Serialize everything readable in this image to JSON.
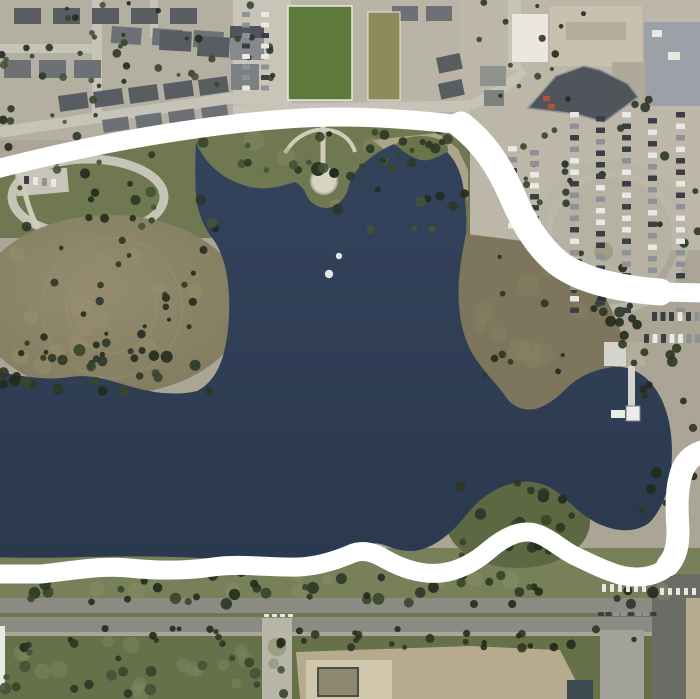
{
  "map": {
    "description_label": "satellite-aerial-view-lake-with-drawn-route",
    "width": 700,
    "height": 699
  },
  "colors": {
    "landBase": "#aaa595",
    "baseTL": "#b3afa1",
    "baseMid": "#b8b4a6",
    "baseTR": "#bcb7a9",
    "parkGreen": "#6f7850",
    "grassBand": "#78805a",
    "scrub": "#667049",
    "water1": "#33435c",
    "water2": "#2b394e",
    "peninsula1": "#958c6f",
    "peninsula2": "#7e7a5e",
    "fieldEast": "#7d765c",
    "fieldGreen": "#5d7a3b",
    "fieldOlive": "#8c8a5a",
    "plaza": "#c8c5b8",
    "streetLight": "#c6c3b7",
    "roadGray": "#8b8b83",
    "roadVert": "#a2a29a",
    "branchRoad": "#b8b5a9",
    "pavementDark": "#6c6c67",
    "median": "#6e7852",
    "dirt": "#b6ab8f",
    "pad": "#cfc6ac",
    "pitDark": "#8e8872",
    "roofDark": "#595d62",
    "roofMid": "#6d7176",
    "buildingWhite": "#e9e7e0",
    "buildingTan": "#c8c1af",
    "buildingTanDark": "#b4ad9a",
    "buildingGray": "#9ba1a6",
    "buildingWing": "#b0a999",
    "stripMall": "#4f555a",
    "midBldgA": "#87898d",
    "midBldgB": "#7d8084",
    "smallBlockA": "#8f938f",
    "smallBlockB": "#7e827e",
    "redAwning": "#b0503a",
    "beach": "#b3aa90",
    "knobGreen": "#6b7348",
    "sePenGreen": "#5c6842",
    "monumentPath": "#cfccba",
    "plazaCircle": "#d7d3c3",
    "ringRoad": "#b8b4a8",
    "loopFill": "#b5b1a3",
    "pierDeck": "#d5d5cd",
    "pierHead": "#eceeea",
    "fountainWhite": "#f2f5f4",
    "dashWhite": "#e9e9e4",
    "treeA": "#2c3626",
    "treeB": "#38452c",
    "treeC": "#222b1c",
    "treeD": "#45523a",
    "mottleLight": "#7d8760",
    "mottleTan": "#9a906f",
    "mottleField": "#8b8266",
    "mottleGrass": "#8a9168",
    "carDark": "#3a3f46",
    "carLight": "#e8e8e4",
    "carGray": "#8e9297",
    "carRed": "#a34a36",
    "annotation": "#ffffff"
  },
  "annotation": {
    "stroke_width": 19,
    "segments": [
      "M -8 170 C 40 158 90 146 150 136 C 210 126 280 117 340 117 C 380 117 430 121 461 125 C 484 143 499 166 511 193 C 523 221 536 245 558 263 C 582 281 620 289 660 292 L 708 293",
      "M 708 449 C 694 452 684 461 680 477 C 675 494 676 514 677 531 C 678 548 675 560 663 570 C 649 579 629 579 611 572 C 597 567 586 561 575 556 C 561 549 549 537 535 533 C 519 529 503 538 489 550 C 475 562 459 571 441 573 C 421 575 401 568 385 559 C 373 552 363 549 351 554 C 337 560 319 566 299 567 C 271 568 241 563 213 567 C 185 571 157 571 129 568 C 101 565 71 571 41 574 L -8 574"
    ],
    "overlay_ne": "M 461 125 C 484 143 499 166 511 193 C 523 221 536 245 558 263 C 582 281 620 289 660 292",
    "overlay_ne_width": 27,
    "overlay_right": "M 702 452 C 690 456 683 464 680 478 C 676 494 677 514 678 530 C 678 545 676 556 668 565",
    "overlay_right_width": 23
  },
  "water_features": {
    "lake_path": "M196 142 C205 165 225 181 250 187 C270 191 284 185 295 182 C302 186 305 191 307 196 C310 203 318 208 327 208 C337 207 345 199 348 189 C350 179 355 171 363 164 C372 156 382 149 394 144 C402 150 411 158 421 160 C431 162 440 155 447 152 C456 161 462 174 464 192 C466 207 467 220 466 233 C462 255 457 278 459 305 C461 330 467 347 478 362 C489 377 499 387 506 397 C513 407 523 411 535 409 C548 406 559 396 570 385 C582 375 596 369 613 367 C623 366 633 369 642 375 C653 383 662 396 667 414 C672 431 673 451 671 470 C669 490 662 510 649 523 C635 533 617 532 599 524 C583 517 571 503 557 492 C544 482 528 479 510 484 C493 489 478 500 467 514 C456 528 443 541 426 548 C411 554 397 550 384 545 C372 541 363 545 353 552 C341 559 325 563 306 563 C271 563 236 560 201 558 C161 556 121 556 81 557 C51 558 21 558 -6 557 L-6 371 C20 376 45 381 70 377 C95 373 115 383 140 389 C160 394 181 395 197 391 C209 385 218 373 223 356 C228 338 230 317 229 296 C228 273 223 253 213 239 C204 228 198 213 196 197 C195 179 195 159 196 142 Z",
    "fountain_dots": [
      {
        "x": 339,
        "y": 256,
        "r": 3.2
      },
      {
        "x": 329,
        "y": 274,
        "r": 4.2
      }
    ],
    "pier": {
      "deck": {
        "x": 628,
        "y": 366,
        "w": 7,
        "h": 47
      },
      "platform": {
        "x": 611,
        "y": 410,
        "w": 14,
        "h": 8
      },
      "head": {
        "x": 626,
        "y": 406,
        "w": 14,
        "h": 15
      }
    }
  },
  "land_features": {
    "east_field_path": "M450 232 L540 243 C563 251 580 263 594 281 C607 297 616 317 623 339 C628 355 624 363 611 368 C597 373 582 379 571 387 C560 396 548 410 534 412 C520 414 505 410 495 398 C482 383 470 365 463 345 C455 322 452 298 453 274 C454 256 449 240 450 232 Z",
    "park_band_points": "0,178 100,152 200,133 300,125 400,124 470,129 470,238 0,238",
    "beach_points": "372,140 438,133 458,149 468,170 468,200 452,168 418,160 386,151",
    "monument_arc": "M285 153 C295 136 312 128 327 130 C342 131 352 141 355 152",
    "monument_walk": "M323 126 L323 170",
    "diag_street": "M0 132 L233 98",
    "mid_road": "M233 110 L470 106",
    "tr_road": "M470 106 C500 92 515 80 524 70",
    "strip_mall_path": "M528 108 L556 76 L584 66 L600 70 L628 84 L638 97 L604 122 L576 114 Z"
  },
  "seed": 20240613,
  "decorations": {
    "blob_regions": [
      {
        "layer": "blobs-layer",
        "name": "ground-mottle",
        "x": 0,
        "y": 640,
        "w": 300,
        "h": 55,
        "n": 18,
        "rmin": 5,
        "rmax": 10,
        "op": 0.5,
        "colors": [
          "mottleLight"
        ]
      },
      {
        "layer": "blobs-layer",
        "name": "ground-mottle",
        "x": 15,
        "y": 250,
        "w": 200,
        "h": 118,
        "n": 14,
        "rmin": 6,
        "rmax": 12,
        "op": 0.45,
        "colors": [
          "mottleTan"
        ]
      },
      {
        "layer": "blobs-layer",
        "name": "ground-mottle",
        "x": 465,
        "y": 250,
        "w": 140,
        "h": 118,
        "n": 12,
        "rmin": 6,
        "rmax": 12,
        "op": 0.45,
        "colors": [
          "mottleField"
        ]
      },
      {
        "layer": "blobs-layer",
        "name": "ground-mottle",
        "x": 0,
        "y": 575,
        "w": 700,
        "h": 24,
        "n": 16,
        "rmin": 5,
        "rmax": 9,
        "op": 0.4,
        "colors": [
          "mottleGrass"
        ]
      },
      {
        "layer": "blobs-layer",
        "name": "ground-mottle",
        "x": 235,
        "y": 130,
        "w": 230,
        "h": 90,
        "n": 10,
        "rmin": 6,
        "rmax": 11,
        "op": 0.35,
        "colors": [
          "mottleGrass"
        ]
      }
    ],
    "tree_regions": [
      {
        "x": 0,
        "y": 0,
        "w": 230,
        "h": 126,
        "n": 40,
        "rmin": 2,
        "rmax": 4.5,
        "colors": [
          "treeA",
          "treeB",
          "treeC",
          "treeD"
        ]
      },
      {
        "x": 233,
        "y": 0,
        "w": 58,
        "h": 100,
        "n": 8,
        "rmin": 2,
        "rmax": 4,
        "colors": [
          "treeA",
          "treeB"
        ]
      },
      {
        "x": 470,
        "y": 0,
        "w": 120,
        "h": 108,
        "n": 14,
        "rmin": 2,
        "rmax": 4,
        "colors": [
          "treeA",
          "treeC",
          "treeB"
        ]
      },
      {
        "x": 560,
        "y": 95,
        "w": 138,
        "h": 235,
        "n": 16,
        "rmin": 2.5,
        "rmax": 5,
        "colors": [
          "treeA",
          "treeC"
        ]
      },
      {
        "x": 0,
        "y": 130,
        "w": 468,
        "h": 100,
        "n": 52,
        "rmin": 2.5,
        "rmax": 5.5,
        "colors": [
          "treeA",
          "treeB",
          "treeC",
          "treeD"
        ]
      },
      {
        "x": 10,
        "y": 240,
        "w": 208,
        "h": 128,
        "n": 30,
        "rmin": 2,
        "rmax": 4.5,
        "colors": [
          "treeA",
          "treeC"
        ]
      },
      {
        "x": 0,
        "y": 350,
        "w": 212,
        "h": 44,
        "n": 26,
        "rmin": 3,
        "rmax": 6,
        "colors": [
          "treeA",
          "treeC",
          "treeB"
        ]
      },
      {
        "x": 360,
        "y": 125,
        "w": 108,
        "h": 44,
        "n": 14,
        "rmin": 2.5,
        "rmax": 5,
        "colors": [
          "treeA",
          "treeB"
        ]
      },
      {
        "x": 470,
        "y": 250,
        "w": 138,
        "h": 128,
        "n": 10,
        "rmin": 2,
        "rmax": 4,
        "colors": [
          "treeA",
          "treeC"
        ]
      },
      {
        "x": 460,
        "y": 482,
        "w": 118,
        "h": 78,
        "n": 20,
        "rmin": 3,
        "rmax": 6,
        "colors": [
          "treeA",
          "treeC",
          "treeB"
        ]
      },
      {
        "x": 0,
        "y": 570,
        "w": 655,
        "h": 34,
        "n": 46,
        "rmin": 3,
        "rmax": 6,
        "colors": [
          "treeA",
          "treeC",
          "treeB"
        ]
      },
      {
        "x": 0,
        "y": 628,
        "w": 700,
        "h": 20,
        "n": 40,
        "rmin": 2.5,
        "rmax": 5,
        "colors": [
          "treeA",
          "treeC"
        ]
      },
      {
        "x": 0,
        "y": 645,
        "w": 285,
        "h": 50,
        "n": 22,
        "rmin": 3,
        "rmax": 6,
        "colors": [
          "treeB",
          "treeA",
          "treeD"
        ]
      },
      {
        "x": 630,
        "y": 330,
        "w": 68,
        "h": 188,
        "n": 18,
        "rmin": 3,
        "rmax": 5.5,
        "colors": [
          "treeA",
          "treeC"
        ]
      },
      {
        "x": 580,
        "y": 295,
        "w": 68,
        "h": 50,
        "n": 12,
        "rmin": 3,
        "rmax": 5.5,
        "colors": [
          "treeA",
          "treeC"
        ]
      },
      {
        "x": 520,
        "y": 130,
        "w": 58,
        "h": 78,
        "n": 10,
        "rmin": 2,
        "rmax": 4,
        "colors": [
          "treeA",
          "treeB"
        ]
      }
    ],
    "house_rows": [
      {
        "x": 14,
        "y": 8,
        "n": 5,
        "dx": 39,
        "dy": 0,
        "w": 27,
        "h": 16,
        "rot": 0,
        "color": "roofDark"
      },
      {
        "x": 112,
        "y": 26,
        "n": 3,
        "dx": 41,
        "dy": 2,
        "w": 30,
        "h": 17,
        "rot": 4,
        "color": "roofMid"
      },
      {
        "x": 4,
        "y": 60,
        "n": 3,
        "dx": 35,
        "dy": 0,
        "w": 27,
        "h": 18,
        "rot": 0,
        "color": "roofMid"
      },
      {
        "x": 58,
        "y": 96,
        "n": 5,
        "dx": 35,
        "dy": -4,
        "w": 29,
        "h": 16,
        "rot": -8,
        "color": "roofDark"
      },
      {
        "x": 102,
        "y": 120,
        "n": 4,
        "dx": 33,
        "dy": -4,
        "w": 26,
        "h": 13,
        "rot": -8,
        "color": "roofMid"
      },
      {
        "x": 160,
        "y": 30,
        "n": 2,
        "dx": 38,
        "dy": 6,
        "w": 32,
        "h": 20,
        "rot": 3,
        "color": "roofDark"
      },
      {
        "x": 392,
        "y": 6,
        "n": 2,
        "dx": 34,
        "dy": 0,
        "w": 26,
        "h": 15,
        "rot": 0,
        "color": "roofMid"
      },
      {
        "x": 436,
        "y": 58,
        "n": 2,
        "dx": 2,
        "dy": 26,
        "w": 24,
        "h": 16,
        "rot": -12,
        "color": "roofDark"
      }
    ],
    "car_rows": [
      {
        "x": 570,
        "y": 112,
        "n": 18,
        "dx": 0,
        "dy": 11.5,
        "w": 9,
        "h": 5.5,
        "colors": [
          "carDark",
          "carLight",
          "carGray",
          "carDark",
          "carLight"
        ]
      },
      {
        "x": 596,
        "y": 116,
        "n": 17,
        "dx": 0,
        "dy": 11.5,
        "w": 9,
        "h": 5.5,
        "colors": [
          "carGray",
          "carDark",
          "carLight",
          "carDark"
        ]
      },
      {
        "x": 622,
        "y": 112,
        "n": 18,
        "dx": 0,
        "dy": 11.5,
        "w": 9,
        "h": 5.5,
        "colors": [
          "carLight",
          "carDark",
          "carGray",
          "carRed",
          "carDark"
        ]
      },
      {
        "x": 648,
        "y": 118,
        "n": 16,
        "dx": 0,
        "dy": 11.5,
        "w": 9,
        "h": 5.5,
        "colors": [
          "carDark",
          "carGray",
          "carLight"
        ]
      },
      {
        "x": 676,
        "y": 112,
        "n": 18,
        "dx": 0,
        "dy": 11.5,
        "w": 9,
        "h": 5.5,
        "colors": [
          "carGray",
          "carLight",
          "carDark",
          "carDark"
        ]
      },
      {
        "x": 508,
        "y": 146,
        "n": 8,
        "dx": 0,
        "dy": 11,
        "w": 9,
        "h": 5.5,
        "colors": [
          "carDark",
          "carLight",
          "carGray"
        ]
      },
      {
        "x": 530,
        "y": 150,
        "n": 8,
        "dx": 0,
        "dy": 11,
        "w": 9,
        "h": 5.5,
        "colors": [
          "carLight",
          "carDark",
          "carGray"
        ]
      },
      {
        "x": 242,
        "y": 12,
        "n": 8,
        "dx": 0,
        "dy": 10.5,
        "w": 8,
        "h": 5,
        "colors": [
          "carDark",
          "carGray",
          "carLight"
        ]
      },
      {
        "x": 261,
        "y": 12,
        "n": 8,
        "dx": 0,
        "dy": 10.5,
        "w": 8,
        "h": 5,
        "colors": [
          "carGray",
          "carDark",
          "carLight"
        ]
      },
      {
        "x": 644,
        "y": 334,
        "n": 7,
        "dx": 8.5,
        "dy": 0,
        "w": 5,
        "h": 9,
        "colors": [
          "carDark",
          "carGray",
          "carDark",
          "carLight"
        ]
      },
      {
        "x": 652,
        "y": 312,
        "n": 6,
        "dx": 8.5,
        "dy": 0,
        "w": 5,
        "h": 9,
        "colors": [
          "carDark",
          "carLight",
          "carGray"
        ]
      },
      {
        "x": 598,
        "y": 612,
        "n": 8,
        "dx": 7.5,
        "dy": 0,
        "w": 6,
        "h": 4,
        "colors": [
          "carDark",
          "carGray",
          "carDark"
        ]
      },
      {
        "x": 24,
        "y": 176,
        "n": 4,
        "dx": 9,
        "dy": 1,
        "w": 5,
        "h": 8,
        "colors": [
          "carDark",
          "carGray",
          "carLight"
        ]
      }
    ],
    "dash_rows": [
      {
        "x": 602,
        "y": 584,
        "n": 6,
        "dx": 8,
        "dy": 0,
        "w": 4,
        "h": 8,
        "colors": [
          "dashWhite"
        ]
      },
      {
        "x": 660,
        "y": 588,
        "n": 5,
        "dx": 8,
        "dy": 0,
        "w": 4,
        "h": 7,
        "colors": [
          "dashWhite"
        ]
      },
      {
        "x": 264,
        "y": 614,
        "n": 4,
        "dx": 8,
        "dy": 0,
        "w": 5,
        "h": 3,
        "colors": [
          "dashWhite"
        ]
      }
    ]
  }
}
